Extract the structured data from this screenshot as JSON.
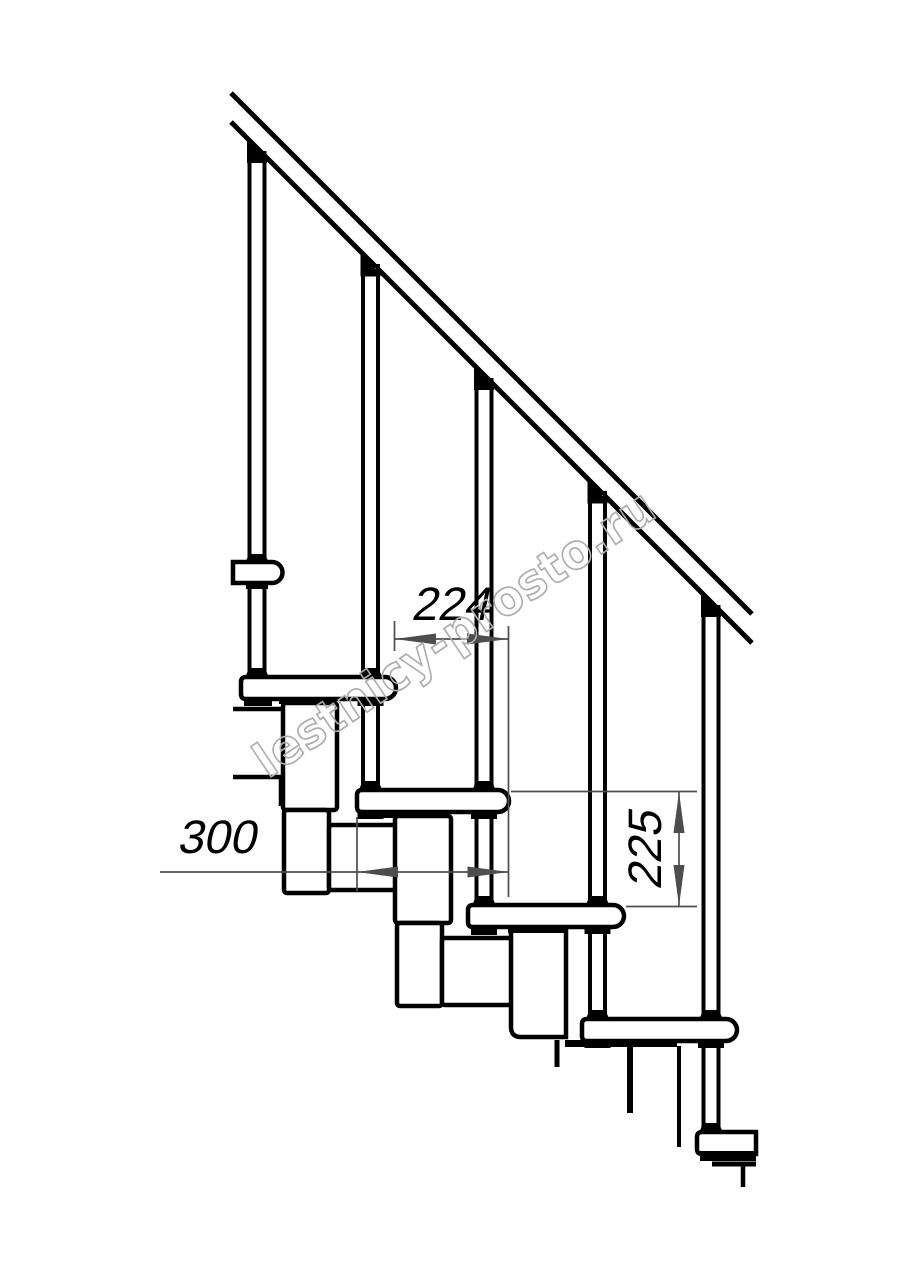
{
  "watermark": {
    "text": "lestnicy-prosto.ru",
    "color": "#adadad"
  },
  "dimensions": {
    "step_run": {
      "label": "224"
    },
    "tread_depth": {
      "label": "300"
    },
    "step_rise": {
      "label": "225"
    }
  },
  "colors": {
    "background": "#ffffff",
    "outline": "#000000",
    "dimension_line": "#4d4d4d"
  }
}
